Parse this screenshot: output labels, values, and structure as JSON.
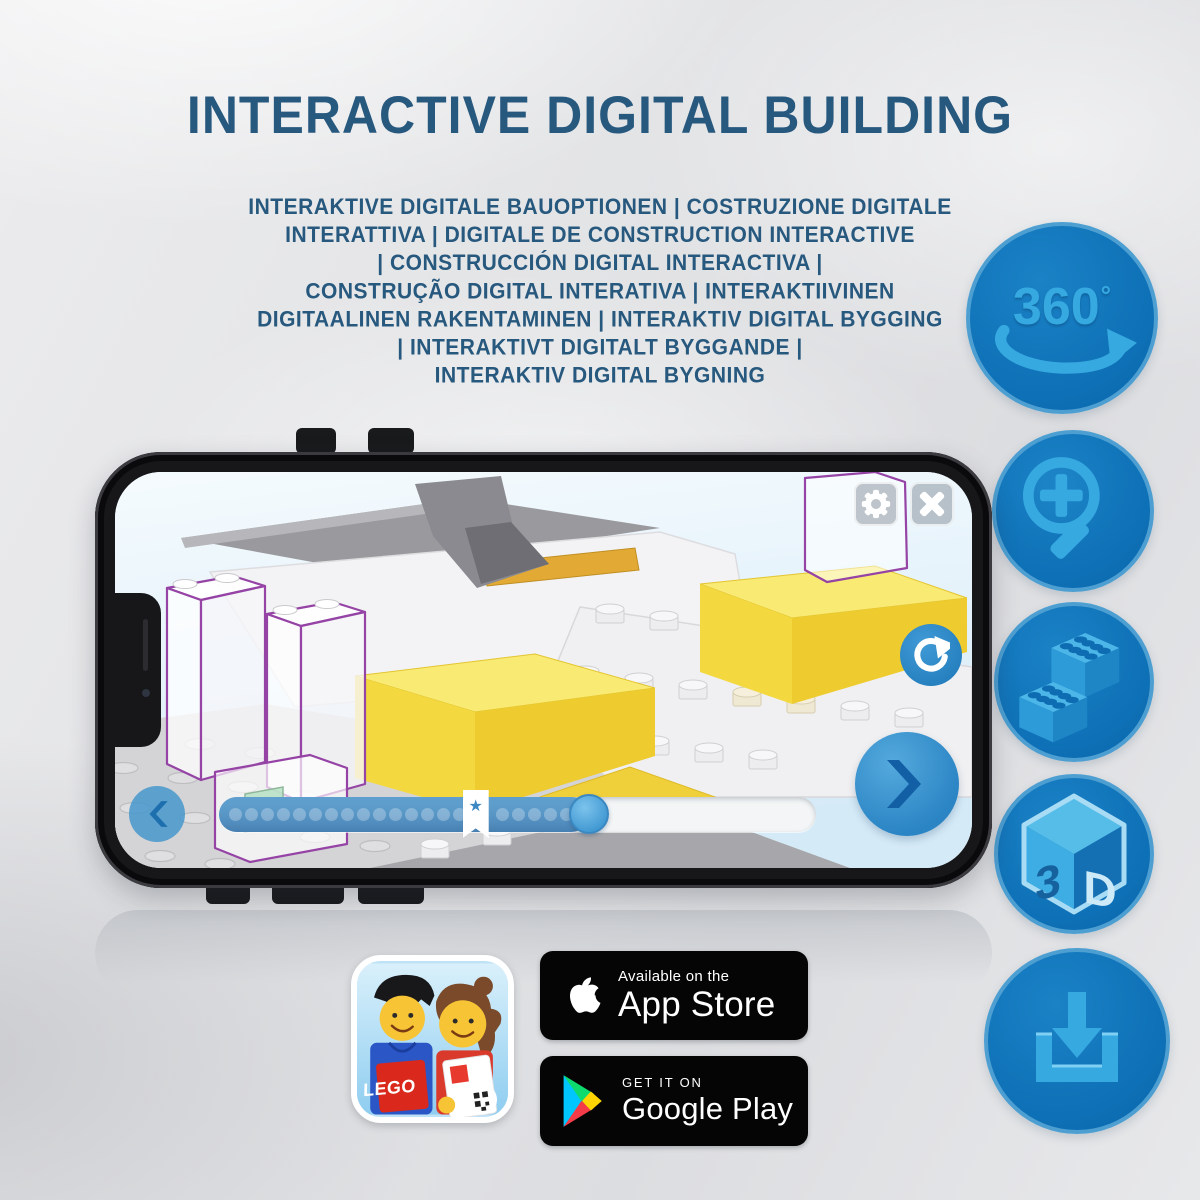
{
  "title": "INTERACTIVE DIGITAL BUILDING",
  "subtitle": {
    "lines": [
      "INTERAKTIVE DIGITALE BAUOPTIONEN | COSTRUZIONE DIGITALE",
      "INTERATTIVA | DIGITALE DE CONSTRUCTION INTERACTIVE",
      "| CONSTRUCCIÓN DIGITAL INTERACTIVA |",
      "CONSTRUÇÃO DIGITAL INTERATIVA | INTERAKTIIVINEN",
      "DIGITAALINEN RAKENTAMINEN | INTERAKTIV DIGITAL BYGGING",
      "| INTERAKTIVT DIGITALT BYGGANDE |",
      "INTERAKTIV DIGITAL BYGNING"
    ]
  },
  "features": {
    "rotation_360": {
      "value": "360",
      "degree_symbol": "°",
      "icon": "rotate-360-icon"
    },
    "zoom": {
      "icon": "magnifier-plus-icon"
    },
    "bricks": {
      "icon": "lego-bricks-icon"
    },
    "three_d": {
      "left_glyph": "3",
      "right_glyph": "D",
      "icon": "cube-3d-icon"
    },
    "download": {
      "icon": "download-tray-icon"
    }
  },
  "phone": {
    "app": {
      "toolbar": {
        "settings_icon": "gear-icon",
        "close_icon": "close-x-icon"
      },
      "controls": {
        "rotate_icon": "rotate-arrow-icon",
        "prev_icon": "chevron-left-icon",
        "next_icon": "chevron-right-icon"
      },
      "slider": {
        "progress_percent": 62,
        "bookmark_percent": 43,
        "dots_before": 15,
        "dots_after": 5,
        "star_glyph": "★"
      }
    }
  },
  "badges": {
    "app_store": {
      "line1": "Available on the",
      "line2": "App Store",
      "logo": "apple-logo-icon"
    },
    "google_play": {
      "line1": "GET IT ON",
      "line2": "Google Play",
      "logo": "google-play-triangle-icon"
    },
    "lego_app": {
      "logo_text": "LEGO"
    }
  },
  "colors": {
    "title_blue": "#27587e",
    "feature_circle_blue": "#0e70b6",
    "feature_icon_blue": "#36a9e1",
    "app_accent_blue": "#2f8cca",
    "brick_yellow": "#f3d840",
    "badge_black": "#050505"
  }
}
